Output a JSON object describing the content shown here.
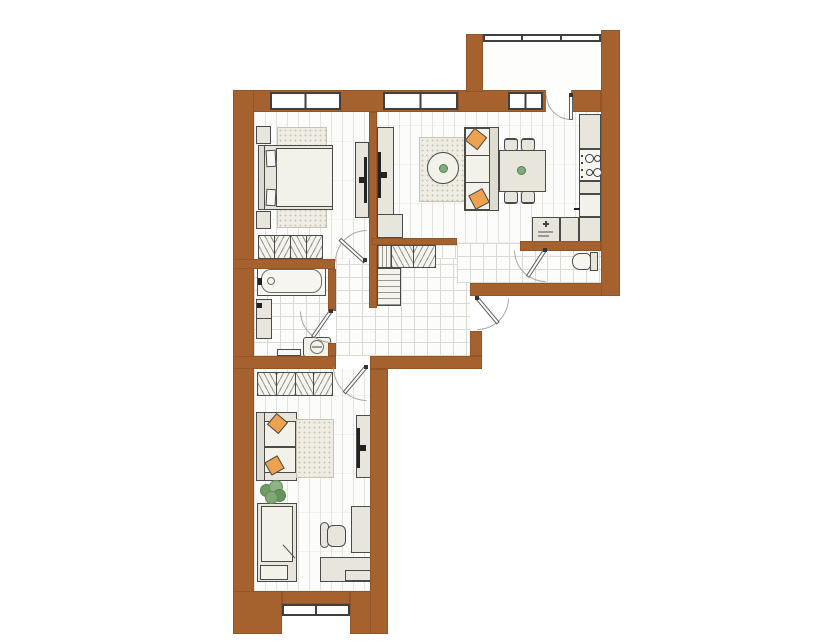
{
  "meta": {
    "type": "apartment-floor-plan",
    "orientation": "top-down"
  },
  "palette": {
    "wall": "#A5612E",
    "outline": "#4A4A48",
    "furniture": "#E8E6DC",
    "furniture_light": "#F2F1EA",
    "floor": "#FCFCFA",
    "wood_line": "#E5E3DD",
    "tile_line": "#DBD9D3",
    "rug": "#EFEDE3",
    "rug_dot": "#C8C5B5",
    "pillow": "#ECA24F",
    "plant": "#7FA874",
    "accent_green": "#7FAD7F",
    "tv": "#222222",
    "glass": "#3F3F3F",
    "door_arc": "#A8A8A8",
    "door_leaf": "#5F5F5F"
  },
  "plan": {
    "rooms": [
      {
        "id": "bedroom",
        "floor": "wood",
        "furniture": [
          "double-bed",
          "nightstand",
          "nightstand",
          "rug",
          "tv-cabinet",
          "tv",
          "wardrobe"
        ]
      },
      {
        "id": "living-room",
        "floor": "wood",
        "furniture": [
          "sofa",
          "throw-pillow",
          "throw-pillow",
          "rug",
          "round-coffee-table",
          "dining-table",
          "chair",
          "chair",
          "chair",
          "chair",
          "tv-cabinet",
          "tv",
          "cabinet"
        ]
      },
      {
        "id": "kitchen",
        "floor": "wood",
        "furniture": [
          "tall-cabinet",
          "stove-4-burners",
          "base-cabinet",
          "fridge",
          "counter",
          "sink-unit"
        ]
      },
      {
        "id": "hallway",
        "floor": "tile",
        "furniture": [
          "closet-shelf",
          "closet-hanging",
          "closet-hanging",
          "shelf-stack"
        ]
      },
      {
        "id": "bathroom",
        "floor": "tile",
        "furniture": [
          "bathtub",
          "vanity-sink",
          "washing-machine",
          "bath-mat"
        ]
      },
      {
        "id": "wc",
        "floor": "tile",
        "furniture": [
          "toilet"
        ]
      },
      {
        "id": "kids-room",
        "floor": "wood",
        "furniture": [
          "wardrobe",
          "sofa",
          "throw-pillow",
          "throw-pillow",
          "rug",
          "plant",
          "single-bed",
          "tv-cabinet",
          "tv",
          "cabinet",
          "desk",
          "office-chair"
        ]
      },
      {
        "id": "balcony",
        "floor": "plain",
        "furniture": []
      }
    ],
    "doors": [
      "bedroom-door",
      "bathroom-door",
      "kids-room-door",
      "entrance-door",
      "wc-door",
      "balcony-door"
    ],
    "windows": [
      "bedroom-window",
      "living-room-window",
      "kitchen-window",
      "kids-room-window",
      "balcony-glazing"
    ]
  }
}
